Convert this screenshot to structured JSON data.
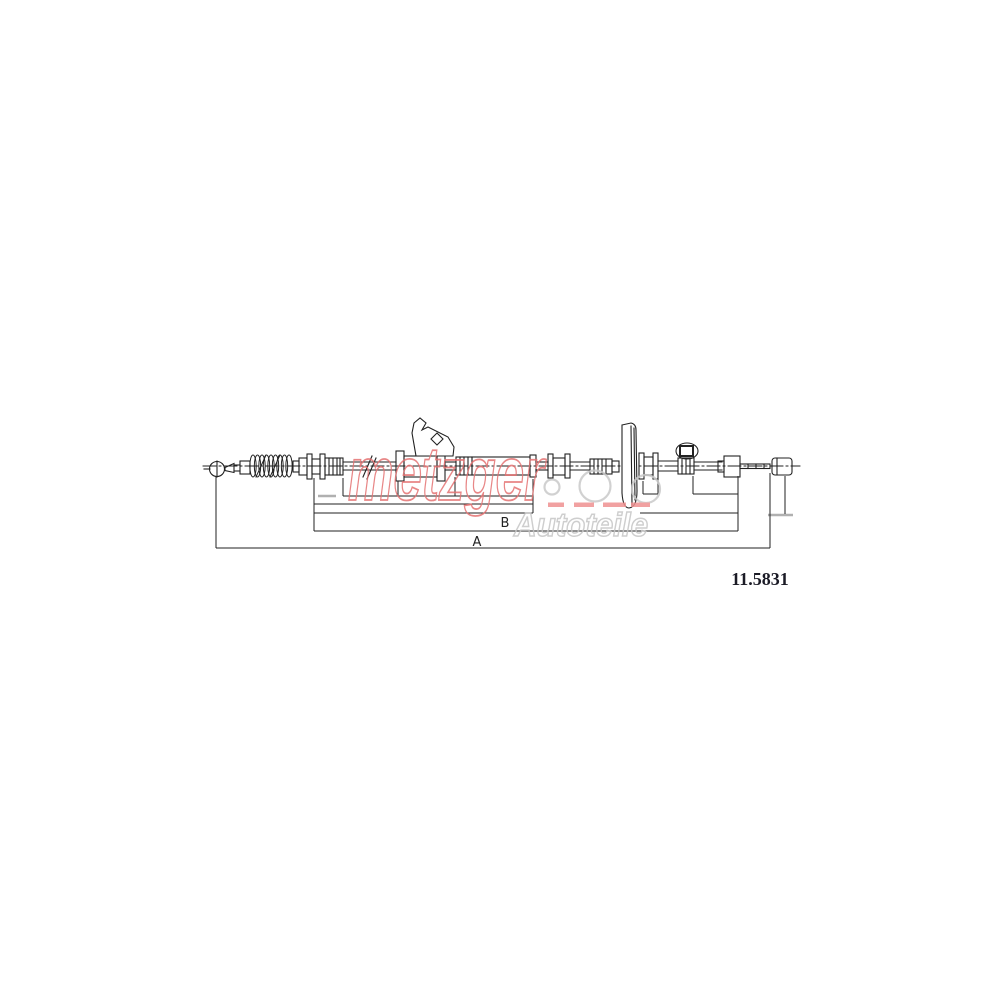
{
  "watermark": {
    "brand": "metzger",
    "suffix": "Autoteile"
  },
  "labels": {
    "overall_dimension": "A",
    "section_dimension": "B"
  },
  "part_number": "11.5831",
  "colors": {
    "line": "#222222",
    "watermark_red": "#e57373",
    "watermark_red_fill": "#ef9191",
    "watermark_gray": "#c6c6c6",
    "dimension_gray_tick": "#b0b0b0",
    "part_number_text": "#1b1b26",
    "background": "#ffffff"
  }
}
